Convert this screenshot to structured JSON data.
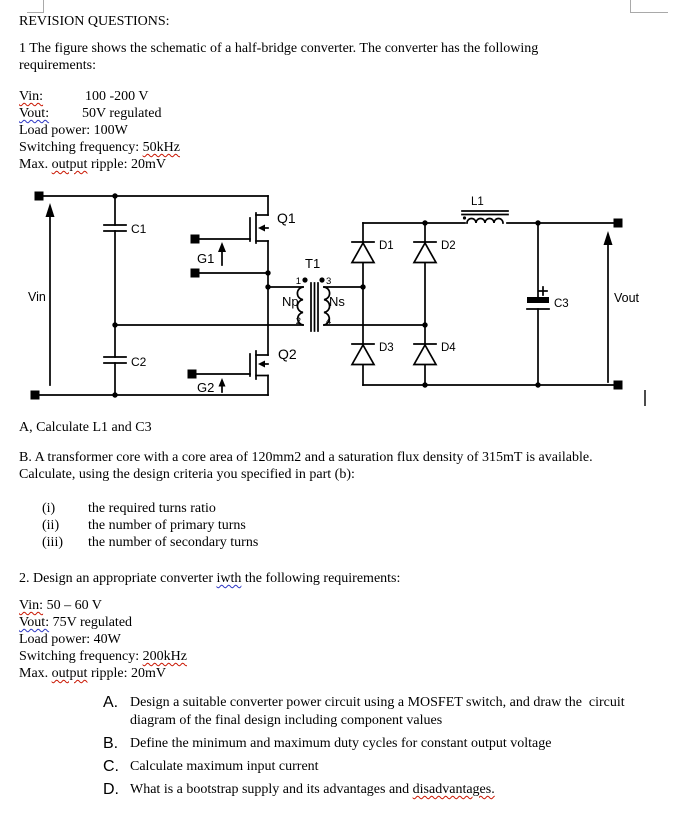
{
  "header": "REVISION QUESTIONS:",
  "q1": {
    "line1": "1 The figure shows the schematic of a half-bridge converter. The converter has the following",
    "line2": "requirements:"
  },
  "specs1": {
    "vin": {
      "label": "Vin:",
      "value": "100 -200 V"
    },
    "vout": {
      "label": "Vout:",
      "value": "50V regulated"
    },
    "load": "Load power: 100W",
    "sw_pre": "Switching frequency: ",
    "sw_val": "50kHz",
    "max_pre": "Max. ",
    "max_word": "output",
    "max_post": " ripple: 20mV"
  },
  "schematic": {
    "labels": {
      "vin": "Vin",
      "vout": "Vout",
      "c1": "C1",
      "c2": "C2",
      "c3": "C3",
      "q1": "Q1",
      "q2": "Q2",
      "g1": "G1",
      "g2": "G2",
      "t1": "T1",
      "np": "Np",
      "ns": "Ns",
      "p1": "1",
      "p2": "2",
      "p3": "3",
      "p4": "4",
      "d1": "D1",
      "d2": "D2",
      "d3": "D3",
      "d4": "D4",
      "l1": "L1"
    }
  },
  "partA": "A, Calculate L1 and C3",
  "partB": {
    "line1": "B. A transformer core with a core area of 120mm2 and a saturation flux density of 315mT is available.",
    "line2": "Calculate, using the design criteria you specified in part (b):"
  },
  "roman": [
    {
      "num": "(i)",
      "text": "the required turns ratio"
    },
    {
      "num": "(ii)",
      "text": "the number of primary turns"
    },
    {
      "num": "(iii)",
      "text": "the number of secondary turns"
    }
  ],
  "q2": {
    "pre": "2. Design an appropriate converter ",
    "typo": "iwth",
    "post": " the following requirements:"
  },
  "specs2": {
    "vin_label": "Vin:",
    "vin_value": " 50 – 60 V",
    "vout_label": "Vout:",
    "vout_value": " 75V regulated",
    "load": "Load power: 40W",
    "sw_pre": "Switching frequency: ",
    "sw_val": "200kHz",
    "max_pre": "Max. ",
    "max_word": "output",
    "max_post": " ripple: 20mV"
  },
  "letters": [
    {
      "num": "A.",
      "text": "Design a suitable converter power circuit using a MOSFET switch, and draw the  circuit diagram of the final design including component values"
    },
    {
      "num": "B.",
      "text": "Define the minimum and maximum duty cycles for constant output voltage"
    },
    {
      "num": "C.",
      "text": "Calculate maximum input current"
    },
    {
      "num": "D.",
      "pre": "What is a bootstrap supply and its advantages and ",
      "wavy": "disadvantages."
    }
  ],
  "colors": {
    "squiggle_red": "#c91400",
    "squiggle_blue": "#2b35c4",
    "crop_mark_gray": "#a9a9a9"
  }
}
